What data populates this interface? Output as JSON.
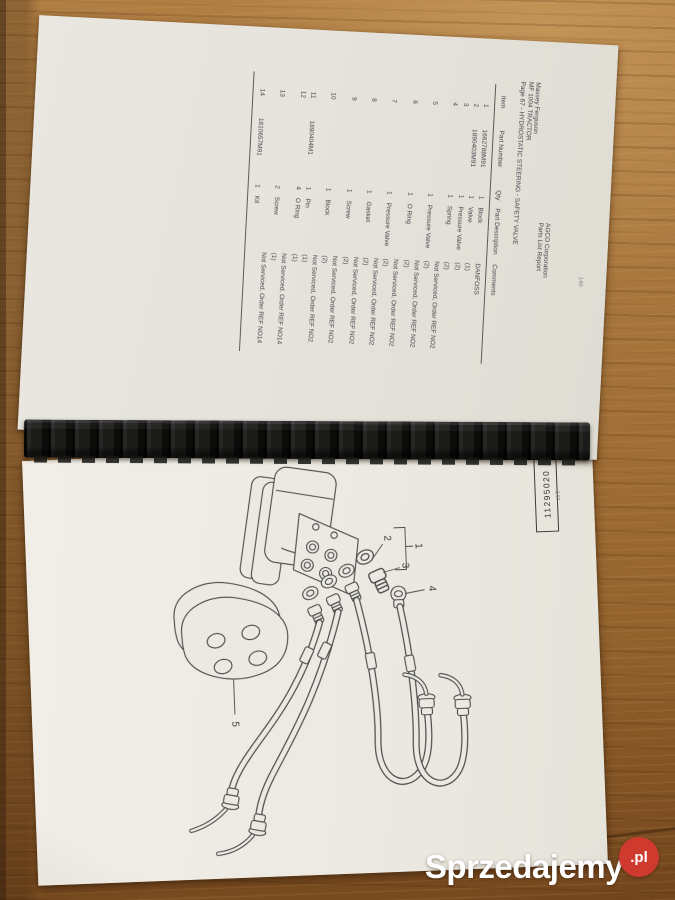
{
  "site_watermark": {
    "name": "Sprzedajemy",
    "tld": ".pl",
    "circle_color": "#ce3a2d"
  },
  "book": {
    "top_page": {
      "corner_page_number": "146",
      "report_header": {
        "left_lines": [
          "Massey Ferguson",
          "MF 1004 TRACTOR",
          "Page 67 - HYDROSTATIC STEERING - SAFETY VALVE"
        ],
        "right_lines": [
          "AGCO Corporation",
          "Parts List Report"
        ]
      },
      "parts_table": {
        "columns": [
          "Item",
          "Part Number",
          "Qty",
          "Part Description",
          "Comments"
        ],
        "rows": [
          {
            "item": "1",
            "part_number": "1662788M91",
            "qty": "1",
            "description": "Block",
            "comments": [
              "DANFOSS"
            ]
          },
          {
            "item": "2",
            "part_number": "1890403M91",
            "qty": "1",
            "description": "Valve",
            "comments": [
              "(1)"
            ]
          },
          {
            "item": "3",
            "part_number": "",
            "qty": "1",
            "description": "Pressure Valve",
            "comments": [
              "(2)"
            ]
          },
          {
            "item": "4",
            "part_number": "",
            "qty": "1",
            "description": "Spring",
            "comments": [
              "(2)",
              "Not Serviced, Order REF NO2"
            ]
          },
          {
            "item": "5",
            "part_number": "",
            "qty": "1",
            "description": "Pressure Valve",
            "comments": [
              "(2)",
              "Not Serviced, Order REF NO2"
            ]
          },
          {
            "item": "6",
            "part_number": "",
            "qty": "1",
            "description": "O Ring",
            "comments": [
              "(2)",
              "Not Serviced, Order REF NO2"
            ]
          },
          {
            "item": "7",
            "part_number": "",
            "qty": "1",
            "description": "Pressure Valve",
            "comments": [
              "(2)",
              "Not Serviced, Order REF NO2"
            ]
          },
          {
            "item": "8",
            "part_number": "",
            "qty": "1",
            "description": "Gasket",
            "comments": [
              "(2)",
              "Not Serviced, Order REF NO2"
            ]
          },
          {
            "item": "9",
            "part_number": "",
            "qty": "1",
            "description": "Screw",
            "comments": [
              "(2)",
              "Not Serviced, Order REF NO2"
            ]
          },
          {
            "item": "10",
            "part_number": "",
            "qty": "1",
            "description": "Block",
            "comments": [
              "(2)",
              "Not Serviced, Order REF NO2"
            ]
          },
          {
            "item": "11",
            "part_number": "1890404M1",
            "qty": "1",
            "description": "Pin",
            "comments": [
              "(1)"
            ]
          },
          {
            "item": "12",
            "part_number": "",
            "qty": "4",
            "description": "O Ring",
            "comments": [
              "(1)",
              "Not Serviced, Order REF NO14"
            ]
          },
          {
            "item": "13",
            "part_number": "",
            "qty": "2",
            "description": "Screw",
            "comments": [
              "(1)",
              "Not Serviced, Order REF NO14"
            ]
          },
          {
            "item": "14",
            "part_number": "1810657M91",
            "qty": "1",
            "description": "Kit",
            "comments": []
          }
        ]
      }
    },
    "bottom_page": {
      "corner_page_number": "147",
      "drawing_number": "11295020",
      "diagram_callouts": [
        "1",
        "2",
        "3",
        "4",
        "5"
      ]
    }
  }
}
